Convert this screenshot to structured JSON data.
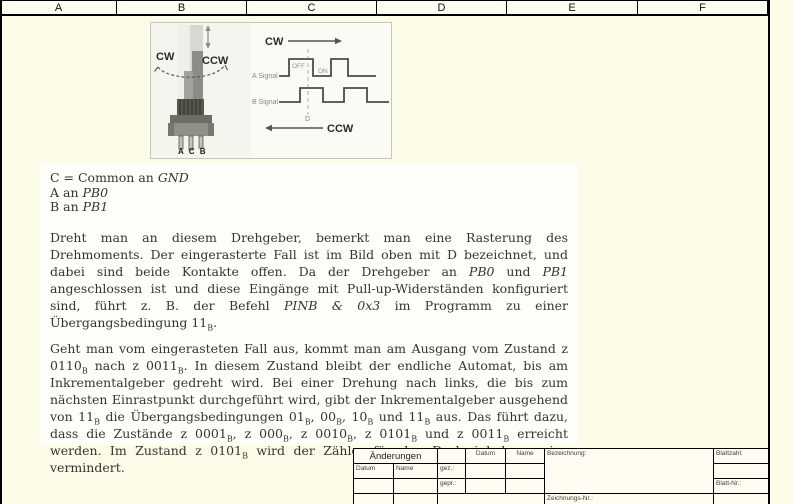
{
  "colors": {
    "page_bg": "#fbfbe7",
    "panel_bg": "#fefefb",
    "frame_line": "#000000",
    "waveform": "#4c4c46",
    "photo_dark": "#57574f"
  },
  "header": {
    "columns": [
      "A",
      "B",
      "C",
      "D",
      "E",
      "F"
    ]
  },
  "figure": {
    "photo": {
      "cw": "CW",
      "ccw": "CCW",
      "pins": "A C B"
    },
    "diagram": {
      "cw": "CW",
      "ccw": "CCW",
      "a_signal": "A Signal",
      "b_signal": "B Signal",
      "off": "OFF",
      "on": "ON",
      "detent": "D"
    }
  },
  "document": {
    "connections": [
      [
        {
          "t": "C = Common an "
        },
        {
          "t": "GND",
          "i": true
        }
      ],
      [
        {
          "t": "A an "
        },
        {
          "t": "PB0",
          "i": true
        }
      ],
      [
        {
          "t": "B an "
        },
        {
          "t": "PB1",
          "i": true
        }
      ]
    ],
    "paragraphs": [
      [
        {
          "t": "Dreht man an diesem Drehgeber, bemerkt man eine Rasterung des Drehmoments. Der eingerasterte Fall ist im Bild oben mit D bezeichnet, und dabei sind beide Kontakte offen. Da der Drehgeber an "
        },
        {
          "t": "PB0",
          "i": true
        },
        {
          "t": " und "
        },
        {
          "t": "PB1",
          "i": true
        },
        {
          "t": " angeschlossen ist und diese Eingänge mit Pull-up-Widerständen konfiguriert sind, führt z. B. der Befehl "
        },
        {
          "t": "PINB & 0x3",
          "i": true
        },
        {
          "t": " im Programm zu einer Übergangsbedingung 11"
        },
        {
          "t": "B",
          "sub": true
        },
        {
          "t": "."
        }
      ],
      [
        {
          "t": "Geht man vom eingerasteten Fall aus, kommt man am Ausgang vom Zustand z 0110"
        },
        {
          "t": "B",
          "sub": true
        },
        {
          "t": " nach z 0011"
        },
        {
          "t": "B",
          "sub": true
        },
        {
          "t": ". In diesem Zustand bleibt der endliche Automat, bis am Inkrementalgeber gedreht wird. Bei einer Drehung nach links, die bis zum nächsten Einrastpunkt durchgeführt wird, gibt der Inkrementalgeber ausgehend von 11"
        },
        {
          "t": "B",
          "sub": true
        },
        {
          "t": " die Übergangsbedingungen 01"
        },
        {
          "t": "B",
          "sub": true
        },
        {
          "t": ", 00"
        },
        {
          "t": "B",
          "sub": true
        },
        {
          "t": ", 10"
        },
        {
          "t": "B",
          "sub": true
        },
        {
          "t": " und 11"
        },
        {
          "t": "B",
          "sub": true
        },
        {
          "t": " aus. Das führt dazu, dass die Zustände z 0001"
        },
        {
          "t": "B",
          "sub": true
        },
        {
          "t": ", z 000"
        },
        {
          "t": "B",
          "sub": true
        },
        {
          "t": ", z 0010"
        },
        {
          "t": "B",
          "sub": true
        },
        {
          "t": ", z 0101"
        },
        {
          "t": "B",
          "sub": true
        },
        {
          "t": " und z 0011"
        },
        {
          "t": "B",
          "sub": true
        },
        {
          "t": " erreicht werden. Im Zustand z 0101"
        },
        {
          "t": "B",
          "sub": true
        },
        {
          "t": " wird der Zähler für den Drehwinkel um eins vermindert."
        }
      ]
    ]
  },
  "title_block": {
    "aenderungen": "Änderungen",
    "datum": "Datum",
    "name": "Name",
    "gez": "gez.:",
    "gepr": "gepr.:",
    "bezeichnung": "Bezeichnung:",
    "blattzahl": "Blattzahl:",
    "blatt_nr": "Blatt-Nr.:",
    "zeichnungs_nr": "Zeichnungs-Nr.:"
  }
}
